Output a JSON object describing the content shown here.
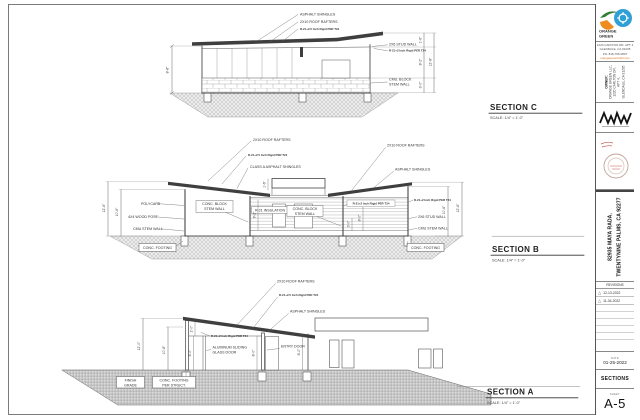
{
  "sections": {
    "c": {
      "title": "SECTION C",
      "scale": "SCALE: 1/4\" = 1'-0\"",
      "labels": {
        "shingles": "ASPHALT SHINGLES",
        "rafters": "2X10 ROOF RAFTERS",
        "rigid25": "R-21+2.5 Inch Rigid PER T24",
        "stud": "2X6 STUD WALL",
        "rigid2": "R-21+2 Inch Rigid PER T24",
        "cmu1": "CMU. BLOCK",
        "cmu2": "STEM WALL"
      },
      "dims": {
        "h": "8'-8\"",
        "r1": "1'-6\"",
        "r2": "8'-2\"",
        "r3": "3'-0\"",
        "total": "12'-8\""
      }
    },
    "b": {
      "title": "SECTION B",
      "scale": "SCALE: 1/4\" = 1'-0\"",
      "labels": {
        "rafters_l": "2X10 ROOF RAFTERS",
        "rigid25": "R-21+2.5 Inch Rigid PER T24",
        "class_a": "CLASS A ASPHALT SHINGLES",
        "rafters_r": "2X10 ROOF RAFTERS",
        "shingles": "ASPHALT SHINGLES",
        "polycarb": "POLYCARB",
        "wood_post": "4X4 WOOD POST",
        "cmu_l": "CMU STEM WALL",
        "conc_block1": "CONC. BLOCK",
        "conc_block2": "STEM WALL",
        "r21": "R-21 INSULATION",
        "conc_block_c1": "CONC. BLOCK",
        "conc_block_c2": "STEM WALL",
        "rigid2_c": "R-21+2 Inch Rigid PER T24",
        "rigid2_r": "R-21+2 Inch Rigid PER T24",
        "stud_r": "2X6 STUD WALL",
        "cmu_r": "CMU STEM WALL",
        "footing_l": "CONC. FOOTING",
        "footing_r": "CONC. FOOTING"
      },
      "dims": {
        "lo": "12'-6\"",
        "li": "10'-6\"",
        "ro": "12'-6\"",
        "ri": "10'-6\"",
        "c1": "9'-2\"",
        "c2": "8'-0\"",
        "c3": "3'-0\"",
        "c4": "1'-6\""
      }
    },
    "a": {
      "title": "SECTION A",
      "scale": "SCALE: 1/4\" = 1'-0\"",
      "labels": {
        "rafters": "2X10 ROOF RAFTERS",
        "rigid25": "R-21+2.5 Inch Rigid PER T24",
        "shingles": "ASPHALT SHINGLES",
        "rigid2": "R-21+2 Inch Rigid PER T24",
        "sliding1": "ALUMINUM SLIDING",
        "sliding2": "GLASS DOOR",
        "entry": "ENTRY DOOR",
        "grade1": "FINISH",
        "grade2": "GRADE",
        "footing1": "CONC. FOOTING",
        "footing2": "PER STRUCT."
      },
      "dims": {
        "lo": "12'-0\"",
        "li": "10'-8\"",
        "d1": "2'-0\"",
        "d2": "8'-0\"",
        "d3": "8'-0\"",
        "d4": "8'-0\""
      }
    }
  },
  "titleblock": {
    "logo": {
      "line1": "ORANGE",
      "line2": "GREEN"
    },
    "firm": {
      "line1": "1220 CARLTON DR. APT 4",
      "line2": "GLENDALE, CA 91205",
      "line3": "PH: 818-766-0807",
      "web": "orangegreenbuild.com"
    },
    "owner": {
      "heading": "OWNER:",
      "line1": "ORANGE GREEN LLC,",
      "line2": "1220 CARLTON DR.",
      "line3": "APT 4,",
      "line4": "GLENDALE, CA 91205"
    },
    "project": {
      "line1": "82935 MAYA RADA,",
      "line2": "TWENTYNINE PALMS, CA 92277"
    },
    "revisions": {
      "heading": "REVISIONS",
      "rows": [
        {
          "mark": "△",
          "date": "12-13-2022"
        },
        {
          "mark": "△",
          "date": "11-04-2022"
        }
      ]
    },
    "date": {
      "label": "DATE",
      "value": "01-25-2022"
    },
    "sheet_title": "SECTIONS",
    "sheet": {
      "label": "SHEET",
      "number": "A-5"
    }
  }
}
